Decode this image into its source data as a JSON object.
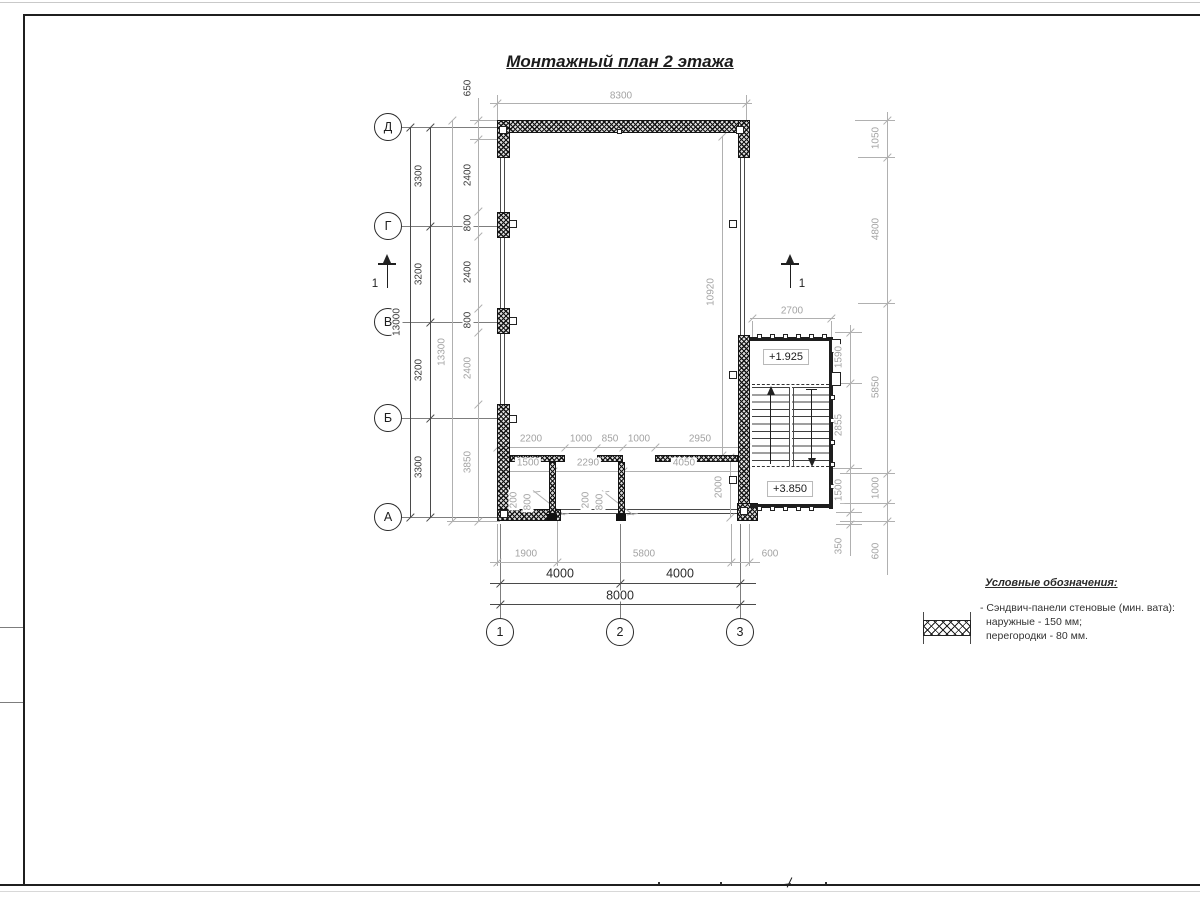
{
  "title": "Монтажный план 2 этажа",
  "axes": {
    "rows": [
      "Д",
      "Г",
      "В",
      "Б",
      "А"
    ],
    "cols": [
      "1",
      "2",
      "3"
    ]
  },
  "section_marks": {
    "left": "1",
    "right": "1"
  },
  "elevations": {
    "landing": "+1.925",
    "upper": "+3.850"
  },
  "dims": {
    "top_offset": "650",
    "top_width": "8300",
    "left_overall": "13000",
    "left_spans": [
      "3300",
      "3200",
      "3200",
      "3300"
    ],
    "left_total": "13300",
    "left_panels": [
      "2400",
      "800",
      "2400",
      "800",
      "2400",
      "3850"
    ],
    "inner_height": "10920",
    "right_outer": [
      "1050",
      "4800",
      "5850",
      "1000",
      "600"
    ],
    "right_inner": [
      "1590",
      "2855",
      "1500",
      "350"
    ],
    "stair_width": "2700",
    "partition_openings": [
      "2200",
      "1000",
      "850",
      "1000",
      "2950"
    ],
    "room_widths": [
      "1500",
      "2290",
      "4050"
    ],
    "door_left": [
      "200",
      "800"
    ],
    "door_right": [
      "200",
      "800"
    ],
    "corridor_depth": "2000",
    "bottom_detail": [
      "1900",
      "5800",
      "600"
    ],
    "bottom_spans": [
      "4000",
      "4000"
    ],
    "bottom_total": "8000"
  },
  "legend": {
    "heading": "Условные обозначения:",
    "item": {
      "symbol": "sandwich-panel-wall-hatch",
      "line1": "- Сэндвич-панели стеновые (мин. вата):",
      "line2": "наружные - 150 мм;",
      "line3": "перегородки - 80 мм."
    }
  },
  "colors": {
    "dim_light": "#b0b0b0",
    "dim_dark": "#3a3a3a",
    "wall": "#141414",
    "frame": "#1f1f1f",
    "paper": "#ffffff"
  }
}
